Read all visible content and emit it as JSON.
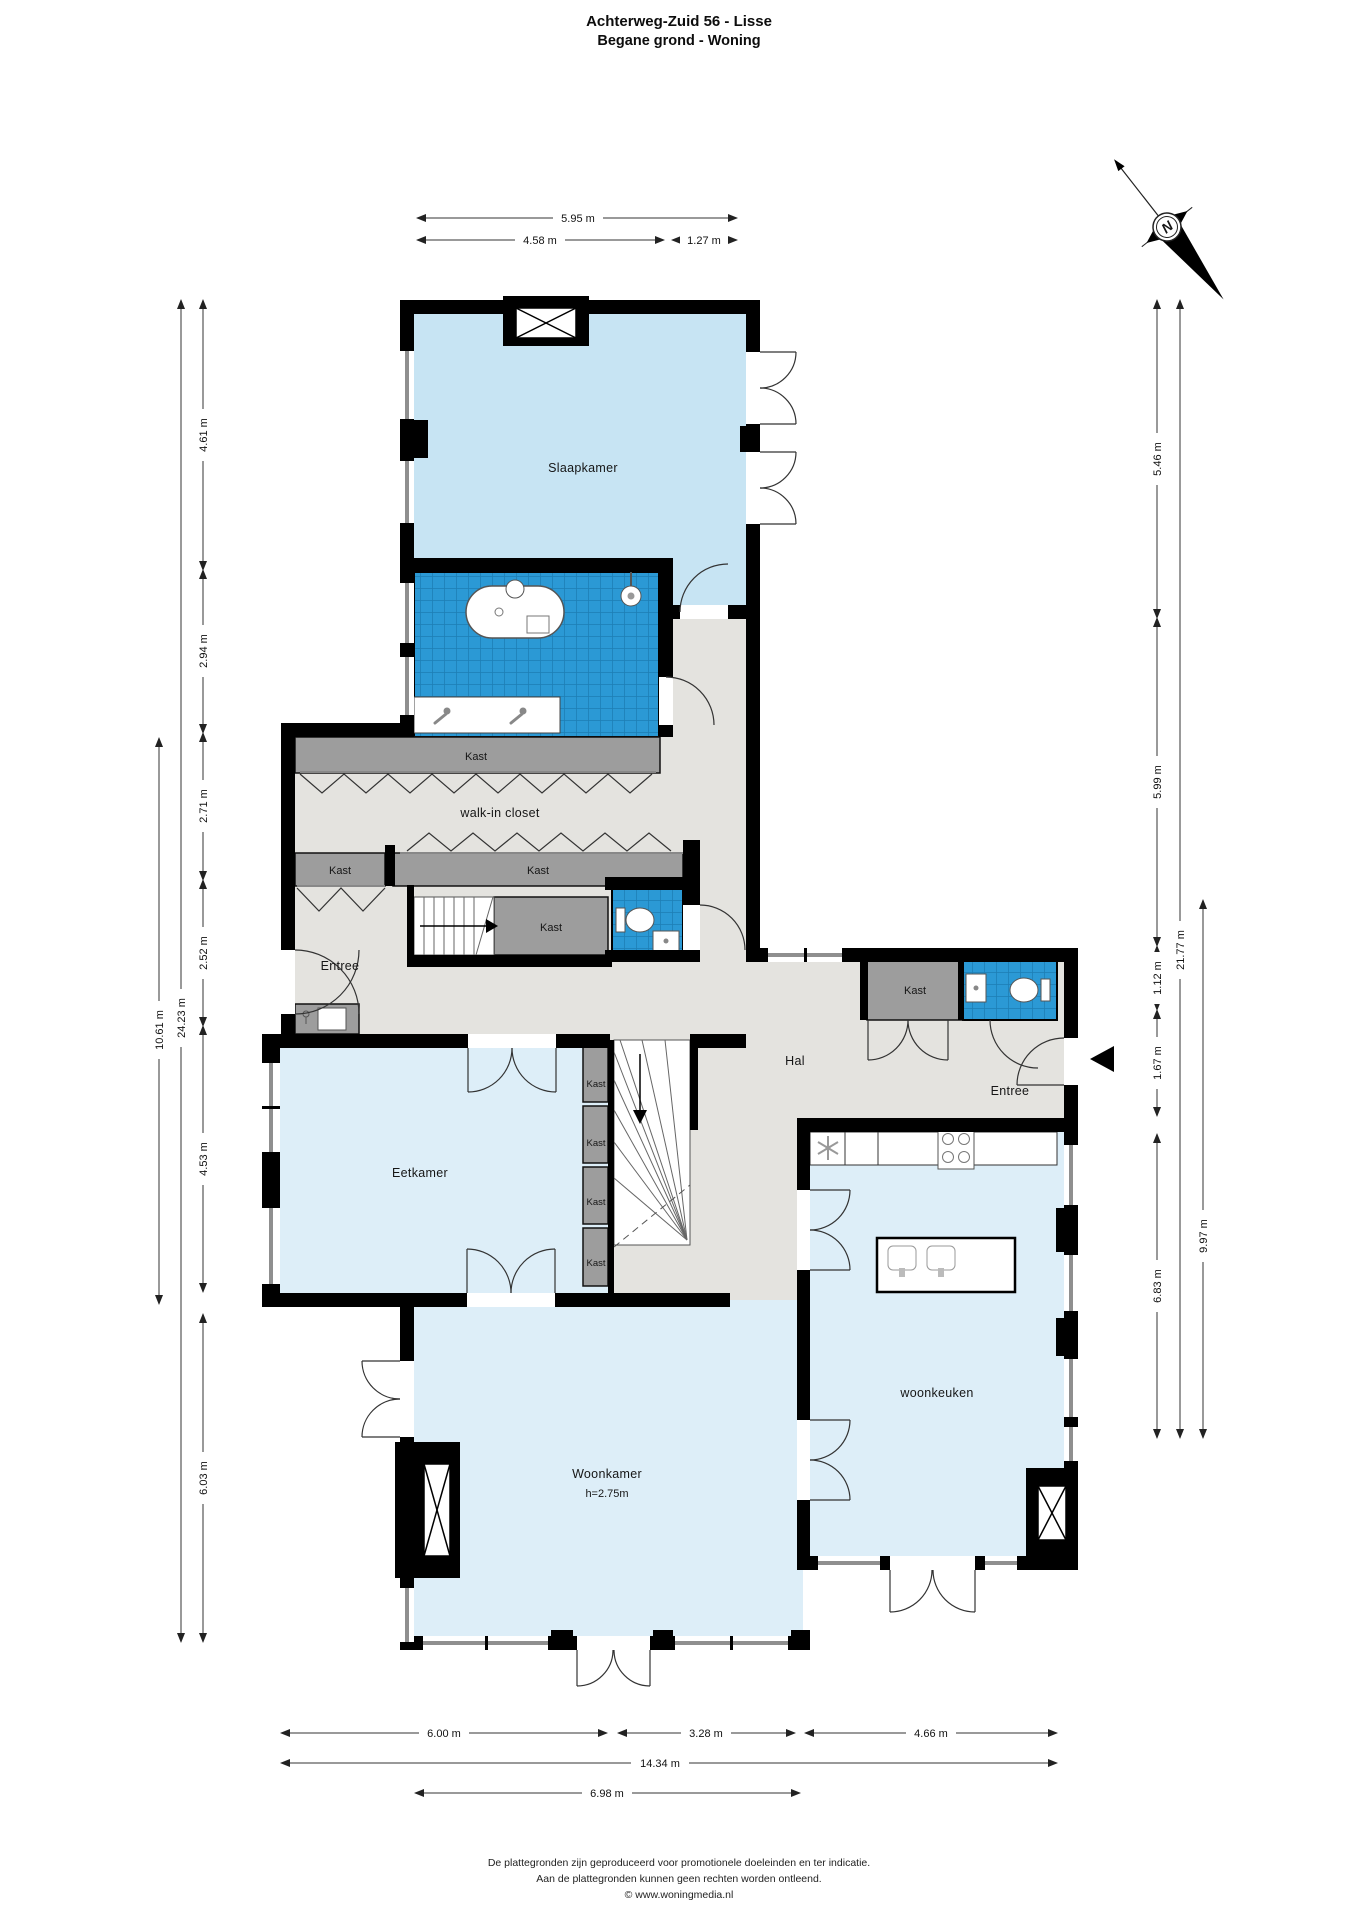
{
  "header": {
    "title": "Achterweg-Zuid 56 - Lisse",
    "subtitle": "Begane grond - Woning"
  },
  "compass": {
    "north_label": "N"
  },
  "rooms": {
    "slaapkamer": "Slaapkamer",
    "walk_in_closet": "walk-in closet",
    "entree_left": "Entree",
    "hal": "Hal",
    "entree_right": "Entree",
    "eetkamer": "Eetkamer",
    "woonkamer": "Woonkamer",
    "woonkamer_height": "h=2.75m",
    "woonkeuken": "woonkeuken"
  },
  "closets": [
    "Kast",
    "Kast",
    "Kast",
    "Kast",
    "Kast",
    "Kast",
    "Kast",
    "Kast",
    "Kast"
  ],
  "dimensions": {
    "top": [
      "5.95 m",
      "4.58 m",
      "1.27 m"
    ],
    "left_inner": [
      "4.61 m",
      "2.94 m",
      "2.71 m",
      "2.52 m",
      "4.53 m",
      "6.03 m"
    ],
    "left_outer": [
      "10.61 m",
      "24.23 m"
    ],
    "right_inner": [
      "5.46 m",
      "5.99 m",
      "1.12 m",
      "1.67 m",
      "6.83 m"
    ],
    "right_outer": [
      "21.77 m",
      "9.97 m"
    ],
    "bottom": [
      "6.00 m",
      "3.28 m",
      "4.66 m",
      "14.34 m",
      "6.98 m"
    ]
  },
  "colors": {
    "wall": "#000000",
    "tile_blue": "#2b99d5",
    "tile_grid": "#1d7eb4",
    "room_blue": "#ddeef8",
    "slaapkamer_blue": "#c7e4f3",
    "floor_gray": "#e4e3df",
    "kast_gray": "#9d9d9d"
  },
  "footer": {
    "line1": "De plattegronden zijn geproduceerd voor promotionele doeleinden en ter indicatie.",
    "line2": "Aan de plattegronden kunnen geen rechten worden ontleend.",
    "line3": "© www.woningmedia.nl"
  }
}
